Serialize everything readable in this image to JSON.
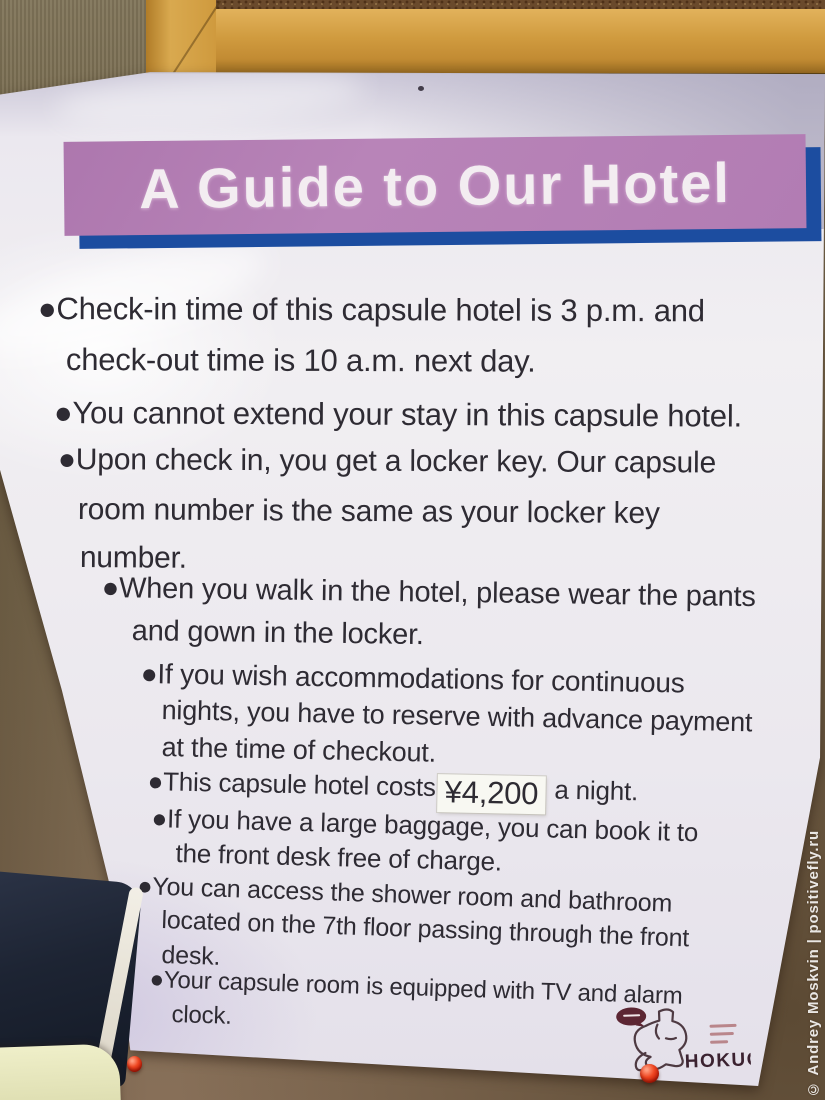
{
  "poster": {
    "title": "A Guide to Our Hotel",
    "bullets": [
      {
        "lines": [
          "●Check-in time of this capsule hotel is 3 p.m. and",
          "check-out time is 10 a.m. next day."
        ]
      },
      {
        "lines": [
          "●You cannot extend your stay in this capsule hotel."
        ]
      },
      {
        "lines": [
          "●Upon check in, you get a locker key. Our capsule",
          "room number is the same as your locker key",
          "number."
        ]
      },
      {
        "lines": [
          "●When you walk in the hotel, please wear the pants",
          "and gown in the locker."
        ]
      },
      {
        "lines": [
          "●If you wish accommodations for continuous",
          "nights, you have to reserve with advance payment",
          "at the time of checkout."
        ]
      },
      {
        "lines": [
          {
            "pre": "●This capsule hotel costs",
            "price": "¥4,200",
            "post": " a night."
          }
        ]
      },
      {
        "lines": [
          "●If you have a large baggage, you can book it to",
          "the front desk free of charge."
        ]
      },
      {
        "lines": [
          "●You can access the shower room and bathroom",
          "located on the 7th floor passing through the front",
          "desk."
        ]
      },
      {
        "lines": [
          "●Your capsule room is equipped with TV and alarm",
          "clock."
        ]
      }
    ],
    "logo": {
      "wordmark": "HOKUO"
    }
  },
  "watermark": {
    "text": "© Andrey Moskvin | positivefly.ru"
  },
  "colors": {
    "banner_purple": "#b27cb3",
    "banner_shadow_blue": "#1c4da0",
    "body_text": "#2e2b33",
    "pin_red": "#e8391b",
    "frame_wood": "#d09b3f"
  }
}
